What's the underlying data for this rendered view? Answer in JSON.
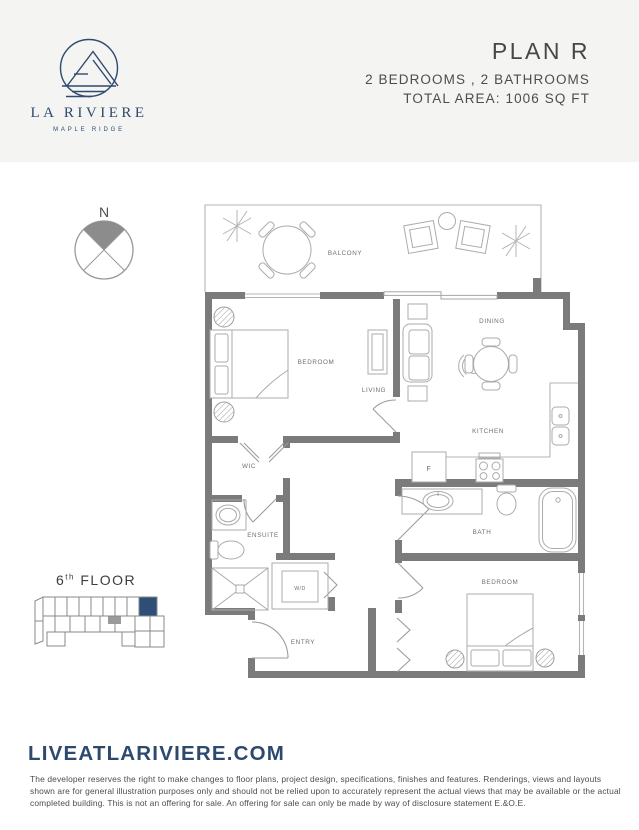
{
  "brand": {
    "name": "LA RIVIERE",
    "tagline": "MAPLE RIDGE"
  },
  "header": {
    "plan": "PLAN R",
    "specs": "2 BEDROOMS , 2 BATHROOMS",
    "area": "TOTAL AREA: 1006 SQ FT"
  },
  "compass": {
    "north": "N"
  },
  "floorplan": {
    "rooms": {
      "balcony": "BALCONY",
      "bedroom_1": "BEDROOM",
      "living": "LIVING",
      "dining": "DINING",
      "kitchen": "KITCHEN",
      "wic": "WIC",
      "ensuite": "ENSUITE",
      "laundry": "W/D",
      "entry": "ENTRY",
      "bath": "BATH",
      "bedroom_2": "BEDROOM",
      "fridge": "F"
    }
  },
  "floor_key": {
    "number": "6",
    "ordinal": "th",
    "label": "FLOOR"
  },
  "footer": {
    "website": "LIVEATLARIVIERE.COM",
    "disclaimer": "The developer reserves the right to make changes to floor plans, project design, specifications, finishes and features. Renderings, views and layouts shown are for general illustration purposes only and should not be relied upon to accurately represent the actual views that may be available or the actual completed building. This is not an offering for sale. An offering for sale can only be made by way of disclosure statement E.&O.E."
  },
  "colors": {
    "navy": "#2e4a6e",
    "wall_gray": "#7b7b7b",
    "highlight_unit": "#2e4d77"
  }
}
